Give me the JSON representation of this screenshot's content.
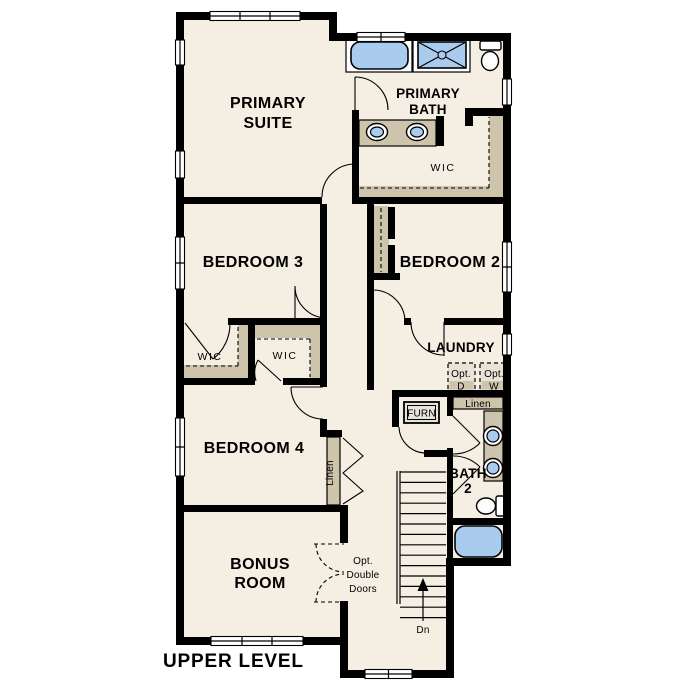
{
  "plan_title": "UPPER LEVEL",
  "rooms": {
    "primary_suite": [
      "PRIMARY",
      "SUITE"
    ],
    "primary_bath": [
      "PRIMARY",
      "BATH"
    ],
    "wic_primary": "WIC",
    "bedroom_3": "BEDROOM 3",
    "bedroom_2": "BEDROOM 2",
    "bedroom_4": "BEDROOM 4",
    "bonus_room": [
      "BONUS",
      "ROOM"
    ],
    "laundry": "LAUNDRY",
    "bath_2": [
      "BATH",
      "2"
    ],
    "wic_bedroom3": "WIC",
    "wic_bedroom4": "WIC"
  },
  "closets": {
    "linen_hall": "Linen",
    "linen_bath2": "Linen"
  },
  "annotations": {
    "furnace": "FURN",
    "stair_direction": "Dn",
    "opt_dryer": [
      "Opt.",
      "D"
    ],
    "opt_washer": [
      "Opt.",
      "W"
    ],
    "opt_double_doors": [
      "Opt.",
      "Double",
      "Doors"
    ]
  },
  "colors": {
    "background": "#ffffff",
    "floor": "#f5eee3",
    "wall": "#000000",
    "casework": "#cec4ac",
    "fixture_blue": "#a9cbee",
    "opt_appliance_fill": "#e8e3d9"
  }
}
